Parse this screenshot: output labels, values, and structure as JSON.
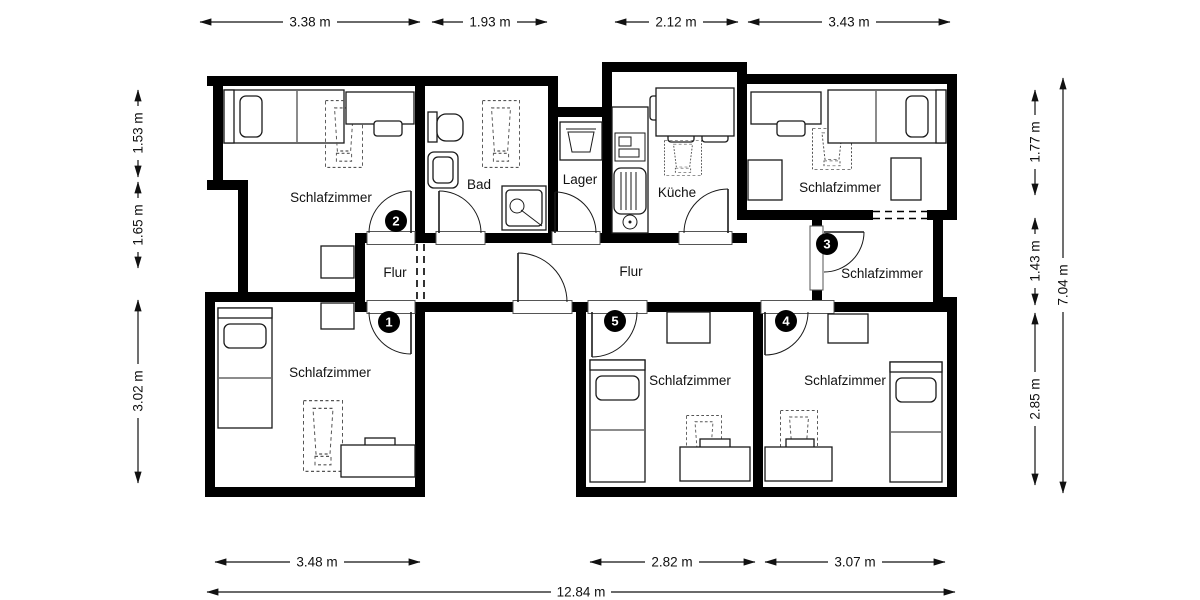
{
  "plan": {
    "rooms": [
      {
        "id": "schlafzimmer-top-left",
        "label": "Schlafzimmer"
      },
      {
        "id": "bad",
        "label": "Bad"
      },
      {
        "id": "lager",
        "label": "Lager"
      },
      {
        "id": "kueche",
        "label": "Küche"
      },
      {
        "id": "schlafzimmer-top-right",
        "label": "Schlafzimmer"
      },
      {
        "id": "flur-left",
        "label": "Flur"
      },
      {
        "id": "flur-main",
        "label": "Flur"
      },
      {
        "id": "schlafzimmer-mid-right",
        "label": "Schlafzimmer"
      },
      {
        "id": "schlafzimmer-bottom-left",
        "label": "Schlafzimmer"
      },
      {
        "id": "schlafzimmer-bottom-center",
        "label": "Schlafzimmer"
      },
      {
        "id": "schlafzimmer-bottom-right",
        "label": "Schlafzimmer"
      }
    ],
    "door_badges": [
      {
        "number": "1"
      },
      {
        "number": "2"
      },
      {
        "number": "3"
      },
      {
        "number": "4"
      },
      {
        "number": "5"
      }
    ],
    "dimensions": {
      "top": [
        {
          "label": "3.38 m"
        },
        {
          "label": "1.93 m"
        },
        {
          "label": "2.12 m"
        },
        {
          "label": "3.43 m"
        }
      ],
      "left": [
        {
          "label": "1.53 m"
        },
        {
          "label": "1.65 m"
        },
        {
          "label": "3.02 m"
        }
      ],
      "right": [
        {
          "label": "1.77 m"
        },
        {
          "label": "1.43 m"
        },
        {
          "label": "2.85 m"
        }
      ],
      "right_total": {
        "label": "7.04 m"
      },
      "bottom": [
        {
          "label": "3.48 m"
        },
        {
          "label": "2.82 m"
        },
        {
          "label": "3.07 m"
        }
      ],
      "bottom_total": {
        "label": "12.84 m"
      }
    },
    "colors": {
      "wall": "#000000",
      "background": "#ffffff",
      "line": "#111111",
      "badge_fill": "#000000",
      "badge_text": "#ffffff"
    }
  }
}
